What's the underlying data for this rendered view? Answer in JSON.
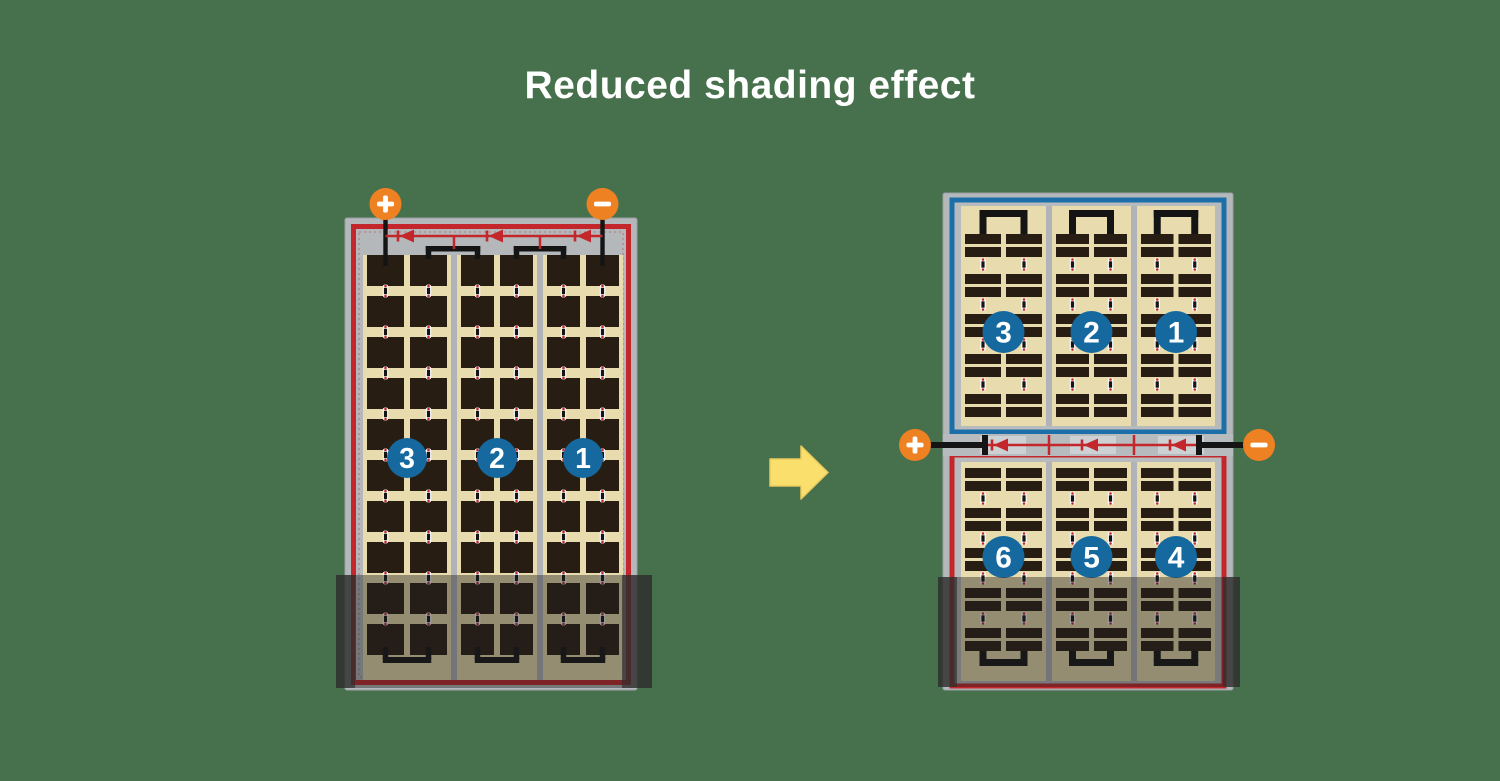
{
  "title": "Reduced shading effect",
  "arrow": {
    "direction": "right"
  },
  "left_panel": {
    "description": "full-size module, single series string, bottom rows shaded",
    "terminals": [
      {
        "sign": "+"
      },
      {
        "sign": "−"
      }
    ],
    "section_badges": [
      "3",
      "2",
      "1"
    ],
    "bypass_diode_count": 3
  },
  "right_panel": {
    "description": "split module, two series strings, bottom rows shaded",
    "terminals": [
      {
        "sign": "+"
      },
      {
        "sign": "−"
      }
    ],
    "top_string": {
      "section_badges": [
        "3",
        "2",
        "1"
      ],
      "border": "#1c6fa8"
    },
    "bottom_string": {
      "section_badges": [
        "6",
        "5",
        "4"
      ],
      "border": "#c3272b"
    },
    "bypass_diode_count": 3
  },
  "colors": {
    "background": "#47704c",
    "title_text": "#ffffff",
    "frame_gray": "#b4b8bb",
    "inner_gray": "#b7bbbe",
    "busbar_gray": "#b0b4b8",
    "cell_area_tan": "#e8dcae",
    "cell_dark": "#281d13",
    "trace_black": "#141414",
    "border_red": "#c3272b",
    "border_blue": "#1c6fa8",
    "badge_blue": "#15699f",
    "terminal_orange": "#ee8122",
    "diode_red": "#c3272b",
    "arrow_yellow": "#fbdf6d",
    "arrow_edge": "#e9cb5e",
    "shade_dark": "#1f1f1f",
    "shade_edge": "#2d2d2d"
  }
}
